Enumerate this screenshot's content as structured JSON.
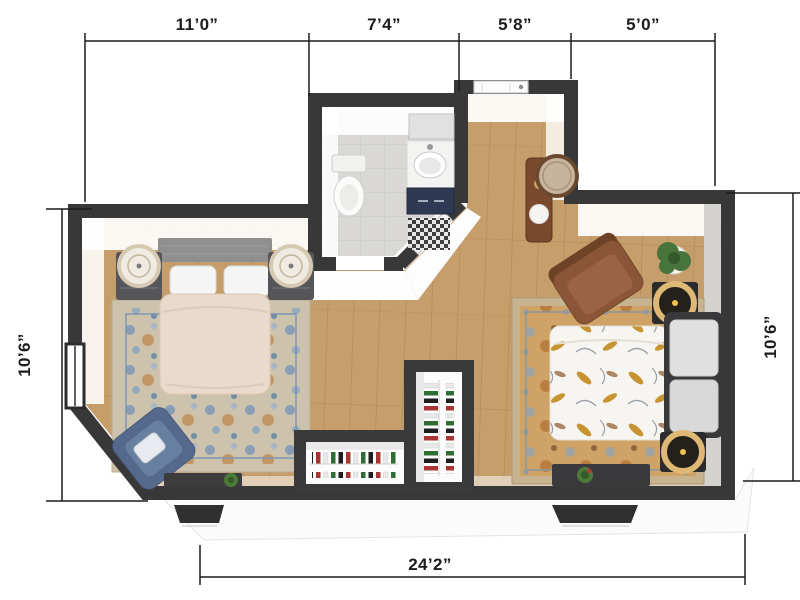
{
  "dimension_labels": {
    "top": [
      "11’0”",
      "7’4”",
      "5’8”",
      "5’0”"
    ],
    "left": "10’6”",
    "right": "10’6”",
    "bottom": "24’2”"
  },
  "colors": {
    "wall": "#383838",
    "wood_floor": "#c69e6b",
    "tile_floor": "#d9d8d4",
    "dimension_line": "#1c1c1c",
    "bedroom_rug_accent": "#7b97b7",
    "living_rug_accent": "#cfa365",
    "vanity_navy": "#2e3a54",
    "armchair_brown": "#8a5637",
    "armchair_blue": "#54698c",
    "lamp_gold": "#dfb875"
  },
  "icons": [
    "queen-bed-icon",
    "nightstand-icon",
    "table-lamp-icon",
    "area-rug-icon",
    "blue-armchair-icon",
    "storage-bench-icon",
    "toilet-icon",
    "vanity-sink-icon",
    "round-mirror-icon",
    "console-table-icon",
    "entry-door-icon",
    "bathroom-door-icon",
    "sofa-icon",
    "floral-daybed-icon",
    "side-table-icon",
    "floor-plant-icon",
    "closet-clothes-icon",
    "window-icon"
  ]
}
